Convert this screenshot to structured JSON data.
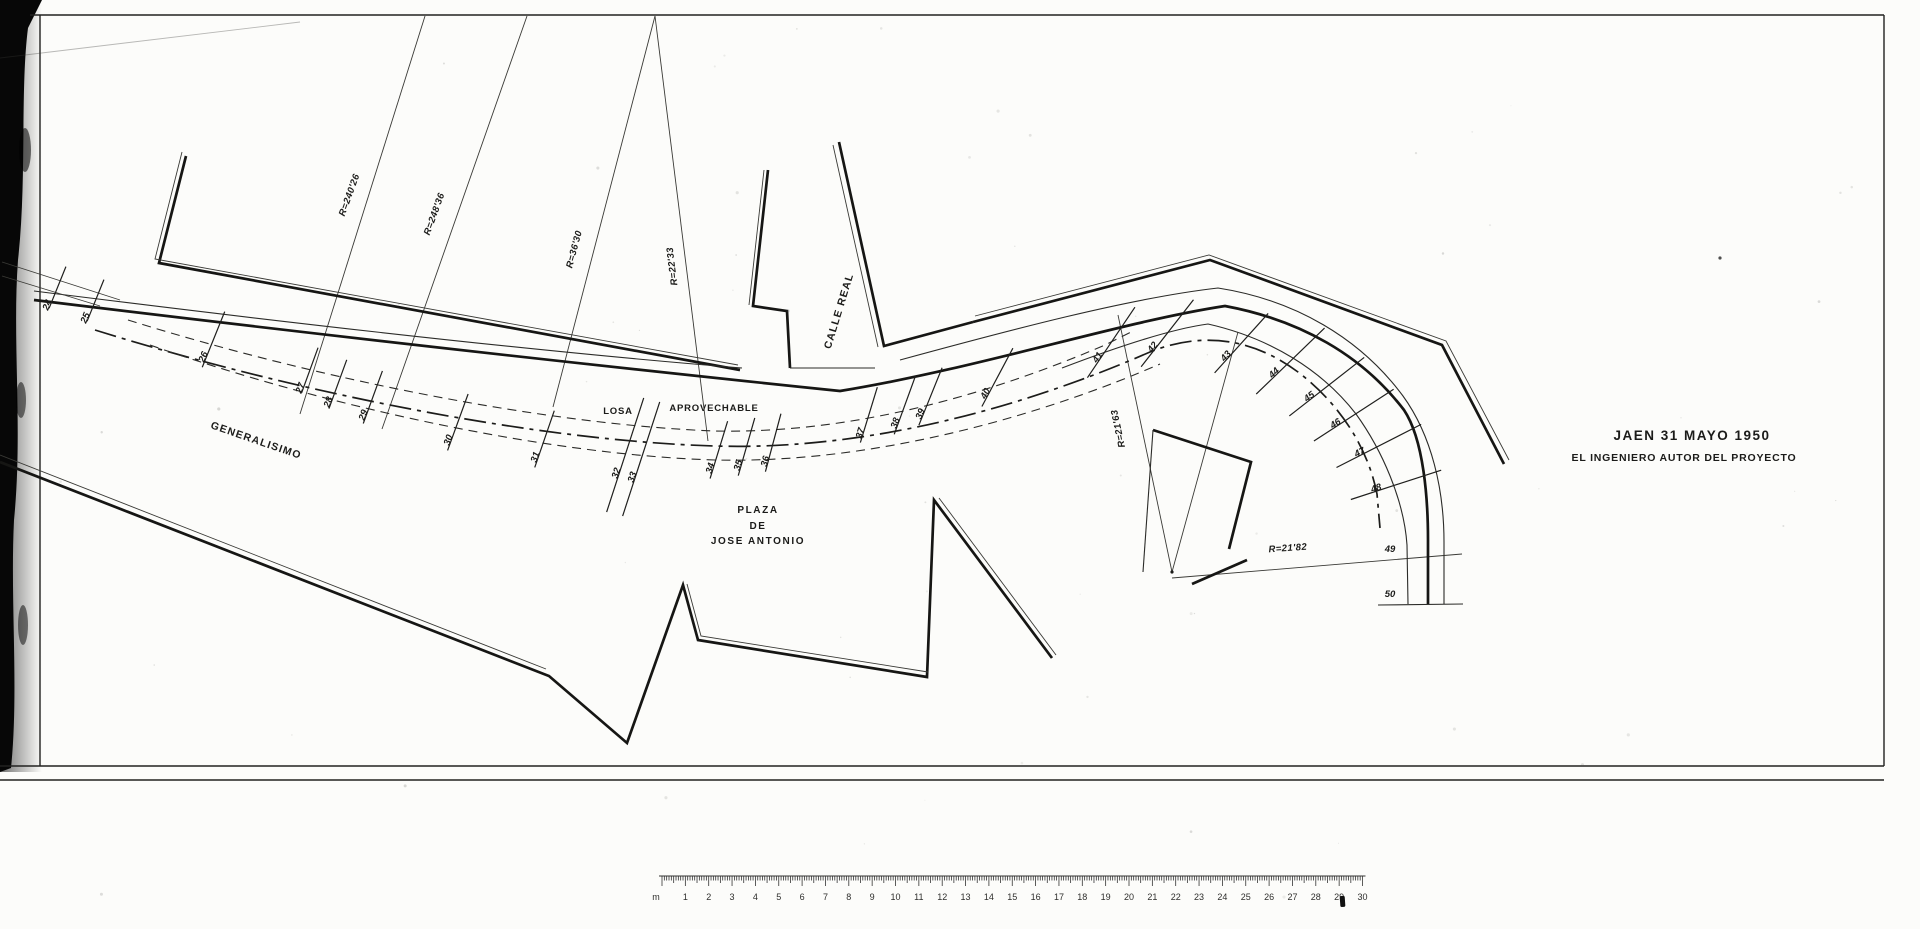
{
  "colors": {
    "ink": "#1c1c1a",
    "paper": "#fcfcfa",
    "scan_edge": "#070707"
  },
  "title_block": {
    "date_line": "JAEN 31 MAYO 1950",
    "author_line": "EL INGENIERO AUTOR DEL PROYECTO"
  },
  "street_labels": {
    "generalisimo": "GENERALISIMO",
    "calle_real": "CALLE REAL",
    "plaza_line1": "PLAZA",
    "plaza_line2": "DE",
    "plaza_line3": "JOSE ANTONIO",
    "losa": "LOSA",
    "aprovechable": "APROVECHABLE"
  },
  "radius_labels": [
    {
      "text": "R=240'26",
      "x": 352,
      "y": 196,
      "rot": -70
    },
    {
      "text": "R=248'36",
      "x": 437,
      "y": 215,
      "rot": -70
    },
    {
      "text": "R=36'30",
      "x": 577,
      "y": 250,
      "rot": -75
    },
    {
      "text": "R=22'33",
      "x": 675,
      "y": 266,
      "rot": -97
    },
    {
      "text": "R=21'63",
      "x": 1121,
      "y": 428,
      "rot": -102
    },
    {
      "text": "R=21'82",
      "x": 1288,
      "y": 551,
      "rot": -4
    }
  ],
  "stations": [
    {
      "label": "24",
      "x": 50,
      "y": 306,
      "angle": 68,
      "len": 45
    },
    {
      "label": "25",
      "x": 88,
      "y": 319,
      "angle": 68,
      "len": 45
    },
    {
      "label": "26",
      "x": 206,
      "y": 358,
      "angle": 68,
      "len": 60
    },
    {
      "label": "27",
      "x": 303,
      "y": 389,
      "angle": 70,
      "len": 48
    },
    {
      "label": "28",
      "x": 331,
      "y": 403,
      "angle": 70,
      "len": 52
    },
    {
      "label": "29",
      "x": 366,
      "y": 416,
      "angle": 70,
      "len": 56
    },
    {
      "label": "30",
      "x": 451,
      "y": 441,
      "angle": 70,
      "len": 60
    },
    {
      "label": "31",
      "x": 538,
      "y": 458,
      "angle": 71,
      "len": 60
    },
    {
      "label": "32",
      "x": 619,
      "y": 474,
      "angle": 72,
      "len": 120
    },
    {
      "label": "33",
      "x": 635,
      "y": 478,
      "angle": 72,
      "len": 120
    },
    {
      "label": "34",
      "x": 713,
      "y": 469,
      "angle": 73,
      "len": 60
    },
    {
      "label": "35",
      "x": 741,
      "y": 466,
      "angle": 74,
      "len": 60
    },
    {
      "label": "36",
      "x": 768,
      "y": 462,
      "angle": 75,
      "len": 60
    },
    {
      "label": "37",
      "x": 863,
      "y": 434,
      "angle": 73,
      "len": 58
    },
    {
      "label": "38",
      "x": 898,
      "y": 424,
      "angle": 70,
      "len": 62
    },
    {
      "label": "39",
      "x": 923,
      "y": 415,
      "angle": 68,
      "len": 62
    },
    {
      "label": "40",
      "x": 988,
      "y": 395,
      "angle": 62,
      "len": 66
    },
    {
      "label": "41",
      "x": 1100,
      "y": 359,
      "angle": 56,
      "len": 85
    },
    {
      "label": "42",
      "x": 1155,
      "y": 349,
      "angle": 52,
      "len": 85
    },
    {
      "label": "43",
      "x": 1228,
      "y": 358,
      "angle": 48,
      "len": 80
    },
    {
      "label": "44",
      "x": 1276,
      "y": 375,
      "angle": 44,
      "len": 95
    },
    {
      "label": "45",
      "x": 1311,
      "y": 399,
      "angle": 38,
      "len": 95
    },
    {
      "label": "46",
      "x": 1337,
      "y": 426,
      "angle": 33,
      "len": 95
    },
    {
      "label": "47",
      "x": 1361,
      "y": 455,
      "angle": 27,
      "len": 95
    },
    {
      "label": "48",
      "x": 1377,
      "y": 491,
      "angle": 18,
      "len": 95
    },
    {
      "label": "49",
      "x": 1390,
      "y": 552,
      "angle": 0,
      "len": 0
    },
    {
      "label": "50",
      "x": 1390,
      "y": 597,
      "angle": 0,
      "len": 0
    }
  ],
  "ruler": {
    "unit_label": "m",
    "numbers": [
      "1",
      "2",
      "3",
      "4",
      "5",
      "6",
      "7",
      "8",
      "9",
      "10",
      "11",
      "12",
      "13",
      "14",
      "15",
      "16",
      "17",
      "18",
      "19",
      "20",
      "21",
      "22",
      "23",
      "24",
      "25",
      "26",
      "27",
      "28",
      "29",
      "30"
    ],
    "x0": 662,
    "y_line": 876,
    "y_numbers": 900,
    "step_minor": 2.335,
    "minor_per_unit": 10
  }
}
